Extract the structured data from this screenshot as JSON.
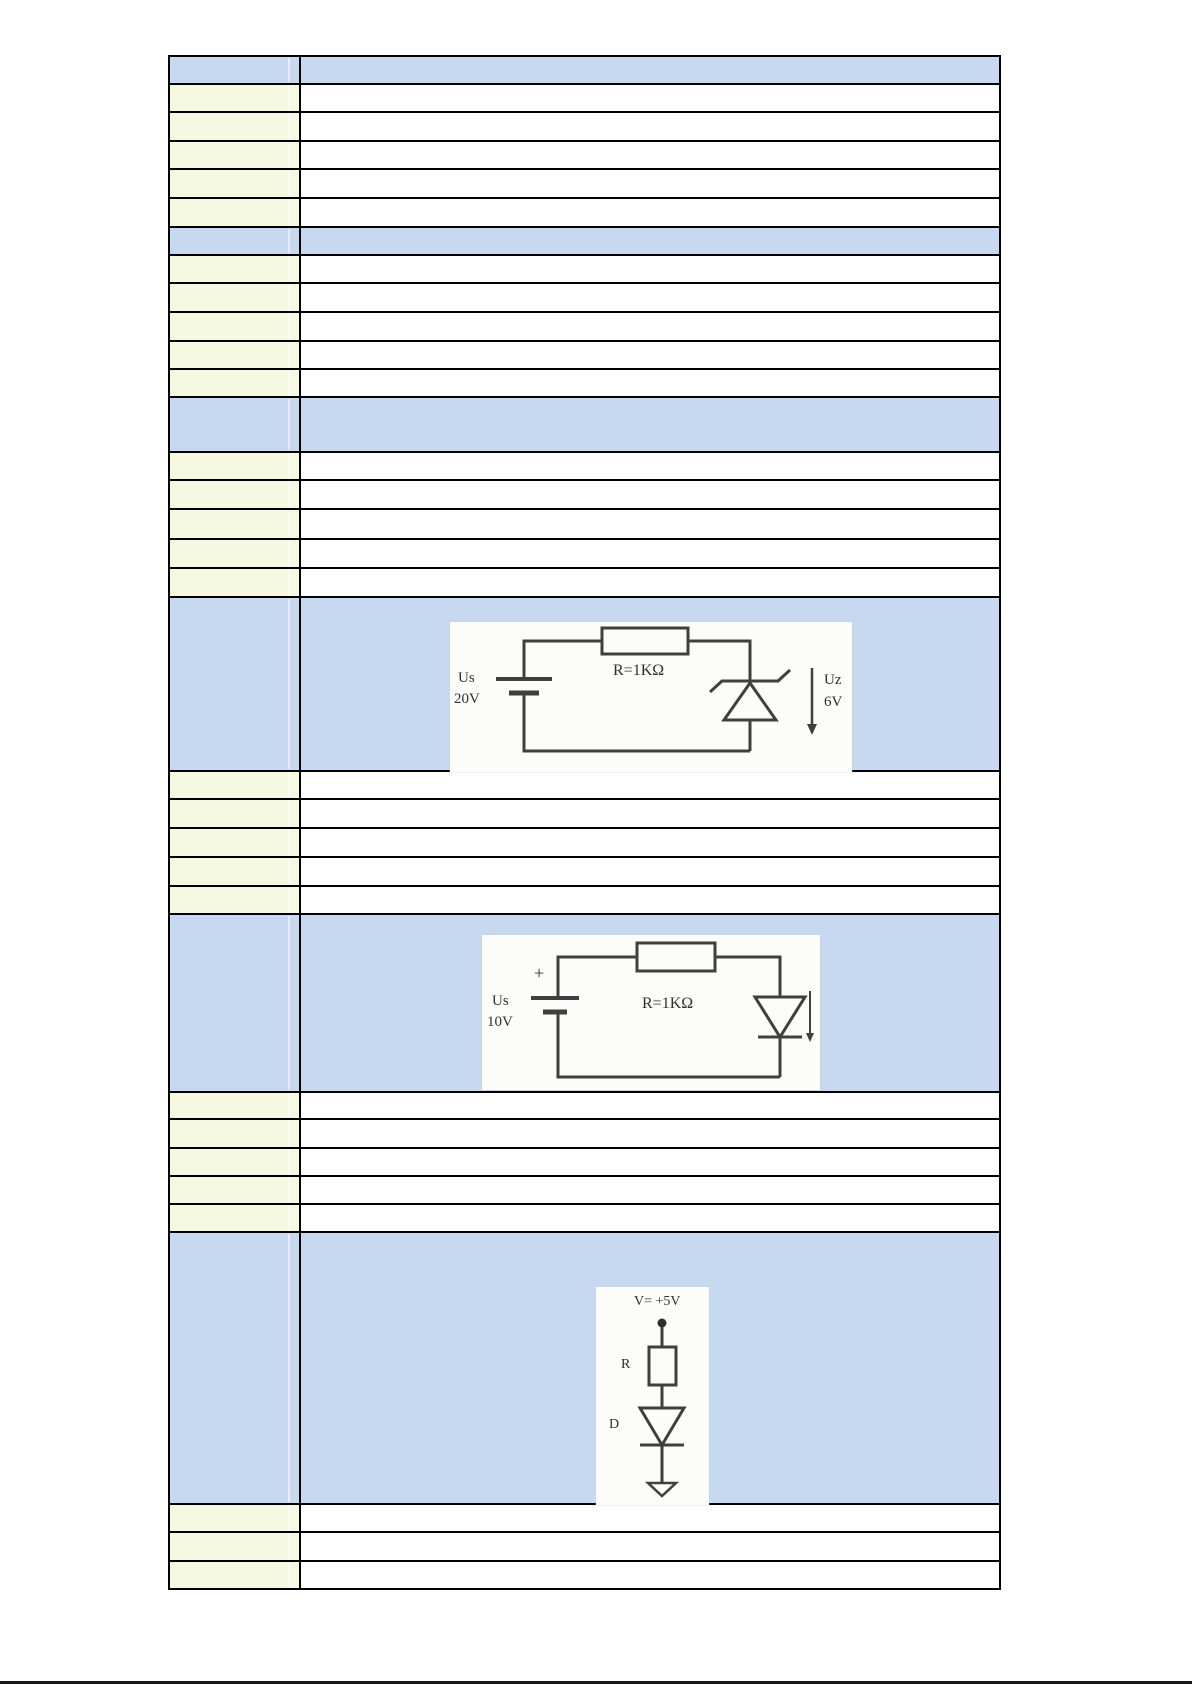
{
  "table": {
    "colors": {
      "section_blue": "#c6d9f0",
      "label_cream": "#f5f9e1",
      "body_white": "#ffffff",
      "border": "#000000"
    },
    "rows": [
      {
        "kind": "header",
        "h": 28
      },
      {
        "kind": "item",
        "h": 28
      },
      {
        "kind": "item",
        "h": 29
      },
      {
        "kind": "item",
        "h": 28
      },
      {
        "kind": "item",
        "h": 29
      },
      {
        "kind": "item",
        "h": 29
      },
      {
        "kind": "section",
        "h": 28
      },
      {
        "kind": "item",
        "h": 28
      },
      {
        "kind": "item",
        "h": 29
      },
      {
        "kind": "item",
        "h": 29
      },
      {
        "kind": "item",
        "h": 28
      },
      {
        "kind": "item",
        "h": 28
      },
      {
        "kind": "section",
        "h": 55
      },
      {
        "kind": "item",
        "h": 28
      },
      {
        "kind": "item",
        "h": 29
      },
      {
        "kind": "item",
        "h": 30
      },
      {
        "kind": "item",
        "h": 29
      },
      {
        "kind": "item",
        "h": 29
      },
      {
        "kind": "section",
        "h": 174,
        "figure": "zener_regulator"
      },
      {
        "kind": "item",
        "h": 28
      },
      {
        "kind": "item",
        "h": 29
      },
      {
        "kind": "item",
        "h": 29
      },
      {
        "kind": "item",
        "h": 29
      },
      {
        "kind": "item",
        "h": 28
      },
      {
        "kind": "section",
        "h": 178,
        "figure": "diode_series"
      },
      {
        "kind": "item",
        "h": 27
      },
      {
        "kind": "item",
        "h": 29
      },
      {
        "kind": "item",
        "h": 28
      },
      {
        "kind": "item",
        "h": 28
      },
      {
        "kind": "item",
        "h": 28
      },
      {
        "kind": "section",
        "h": 272,
        "figure": "pullup_diode"
      },
      {
        "kind": "item",
        "h": 28
      },
      {
        "kind": "item",
        "h": 29
      },
      {
        "kind": "item",
        "h": 28
      }
    ]
  },
  "figures": {
    "zener_regulator": {
      "source_label": "Us",
      "source_voltage": "20V",
      "resistor": "R=1KΩ",
      "output_label": "Uz",
      "output_voltage": "6V"
    },
    "diode_series": {
      "polarity": "+",
      "source_label": "Us",
      "source_voltage": "10V",
      "resistor": "R=1KΩ"
    },
    "pullup_diode": {
      "supply": "V= +5V",
      "resistor_label": "R",
      "diode_label": "D"
    }
  }
}
